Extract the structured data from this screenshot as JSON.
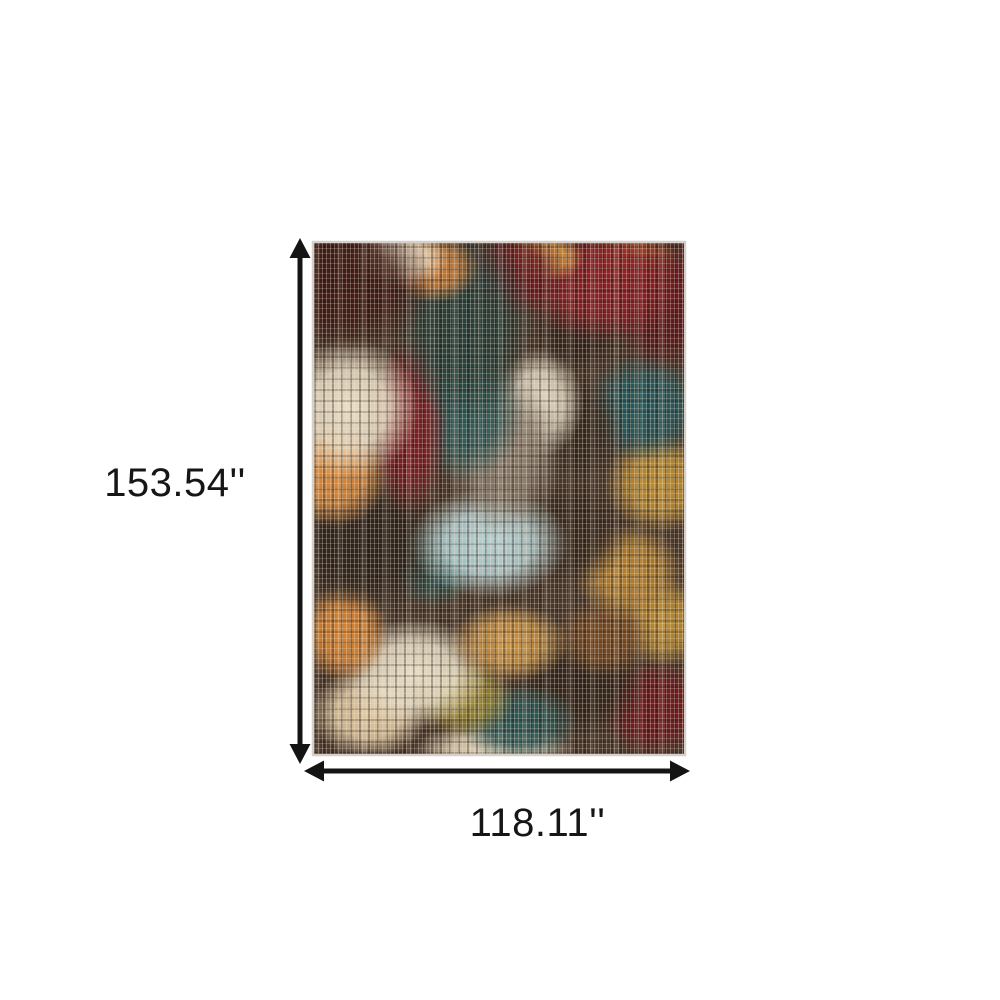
{
  "diagram": {
    "height_label": "153.54''",
    "width_label": "118.11''"
  },
  "image": {
    "subject": "abstract-distressed-crosshatch-area-rug",
    "background_color": "#ffffff",
    "arrow_color": "#141414",
    "rug_palette": [
      "#401a16",
      "#8a1f26",
      "#6d1b20",
      "#d07a30",
      "#d9932f",
      "#bd8c2e",
      "#e8dcc2",
      "#b3d2d6",
      "#2d5a5a",
      "#27403c",
      "#33241c",
      "#8b7c6d"
    ]
  }
}
